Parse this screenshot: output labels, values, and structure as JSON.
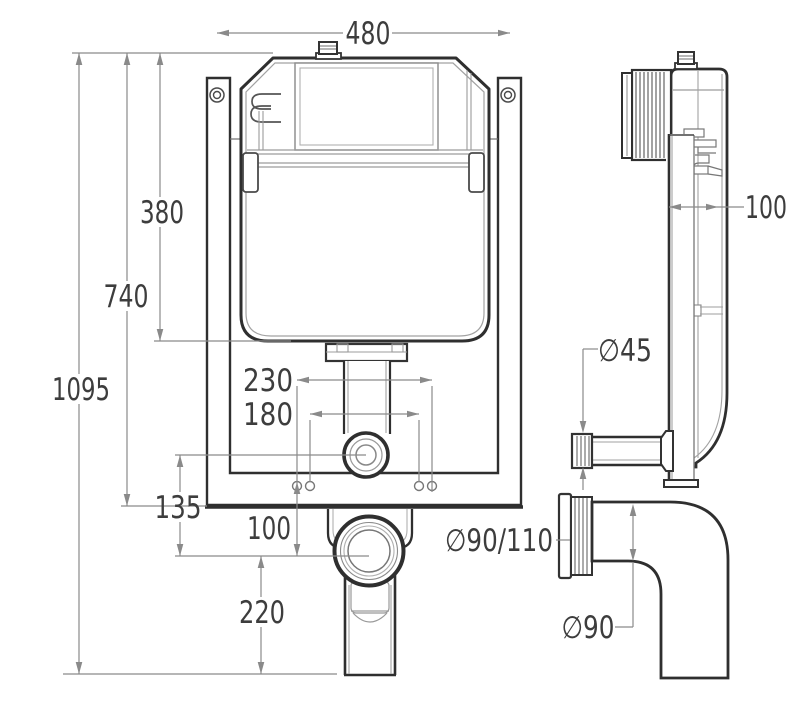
{
  "figure": {
    "type": "technical-drawing",
    "subject": "concealed-cistern-installation-dimensions",
    "units": "mm"
  },
  "colors": {
    "background": "#ffffff",
    "outline": "#2f2f2f",
    "inner_line": "#9c9c9c",
    "dimension_line": "#8a8a8a",
    "dimension_text": "#3d3d3d"
  },
  "front_view": {
    "name": "front view",
    "dimensions": {
      "d480": "480",
      "d380": "380",
      "d740": "740",
      "d1095": "1095",
      "d230": "230",
      "d180": "180",
      "d135": "135",
      "d100": "100",
      "d220": "220"
    }
  },
  "side_view": {
    "name": "side view",
    "dimensions": {
      "depth100": "100",
      "dia45": "∅45",
      "dia90_110": "∅90/110",
      "dia90": "∅90"
    }
  }
}
